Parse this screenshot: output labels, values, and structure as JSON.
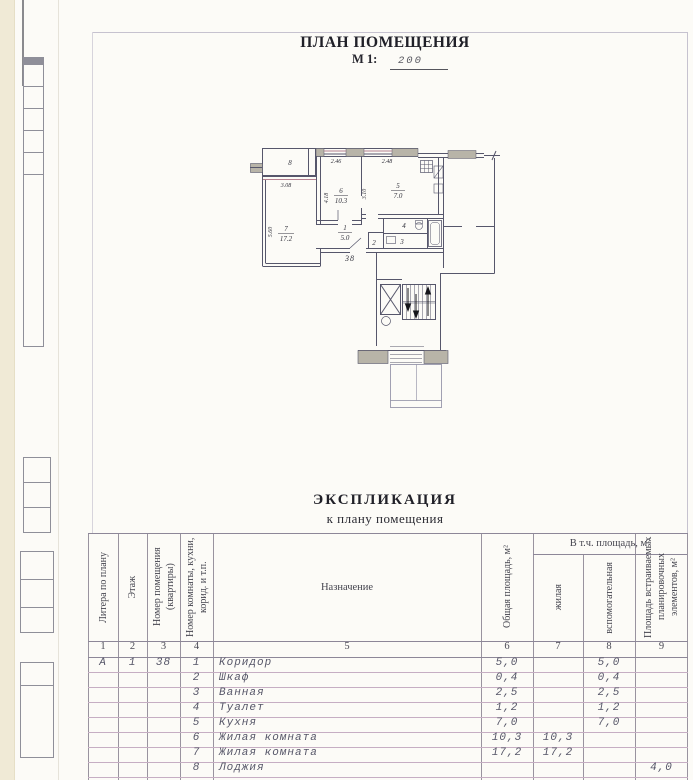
{
  "title": {
    "heading": "ПЛАН ПОМЕЩЕНИЯ",
    "scale_label": "М 1:",
    "scale_value": "200"
  },
  "plan": {
    "apartment_number": "38",
    "labels": {
      "room8": "8",
      "room7": "7",
      "area7": "17.2",
      "room6": "6",
      "area6": "10.3",
      "room5": "5",
      "area5": "7.0",
      "room1": "1",
      "area1": "5.0",
      "room2": "2",
      "room3": "3",
      "room4": "4"
    },
    "dimensions": {
      "win_room6": "2.46",
      "win_kitchen": "2.48",
      "depth_room6": "4.18",
      "depth_kitchen": "3.10",
      "loggia": "3.08",
      "depth_room7": "5.60"
    }
  },
  "explication": {
    "heading": "ЭКСПЛИКАЦИЯ",
    "subheading": "к плану помещения",
    "col_headers": {
      "litera": "Литера по плану",
      "floor": "Этаж",
      "apt": "Номер помещения (квартиры)",
      "room_num": "Номер комнаты, кухни, корид. и т.п.",
      "purpose": "Назначение",
      "total": "Общая площадь, м²",
      "incl": "В т.ч. площадь, м²",
      "living": "жилая",
      "aux": "вспомогательная",
      "builtin": "Площадь встраиваемых планировочных элементов, м²"
    },
    "column_numbers": [
      "1",
      "2",
      "3",
      "4",
      "5",
      "6",
      "7",
      "8",
      "9"
    ],
    "rows": [
      {
        "litera": "А",
        "floor": "1",
        "apt": "38",
        "num": "1",
        "name": "Коридор",
        "total": "5,0",
        "living": "",
        "aux": "5,0",
        "builtin": ""
      },
      {
        "litera": "",
        "floor": "",
        "apt": "",
        "num": "2",
        "name": "Шкаф",
        "total": "0,4",
        "living": "",
        "aux": "0,4",
        "builtin": ""
      },
      {
        "litera": "",
        "floor": "",
        "apt": "",
        "num": "3",
        "name": "Ванная",
        "total": "2,5",
        "living": "",
        "aux": "2,5",
        "builtin": ""
      },
      {
        "litera": "",
        "floor": "",
        "apt": "",
        "num": "4",
        "name": "Туалет",
        "total": "1,2",
        "living": "",
        "aux": "1,2",
        "builtin": ""
      },
      {
        "litera": "",
        "floor": "",
        "apt": "",
        "num": "5",
        "name": "Кухня",
        "total": "7,0",
        "living": "",
        "aux": "7,0",
        "builtin": ""
      },
      {
        "litera": "",
        "floor": "",
        "apt": "",
        "num": "6",
        "name": "Жилая комната",
        "total": "10,3",
        "living": "10,3",
        "aux": "",
        "builtin": ""
      },
      {
        "litera": "",
        "floor": "",
        "apt": "",
        "num": "7",
        "name": "Жилая комната",
        "total": "17,2",
        "living": "17,2",
        "aux": "",
        "builtin": ""
      },
      {
        "litera": "",
        "floor": "",
        "apt": "",
        "num": "8",
        "name": "Лоджия",
        "total": "",
        "living": "",
        "aux": "",
        "builtin": "4,0"
      }
    ]
  }
}
